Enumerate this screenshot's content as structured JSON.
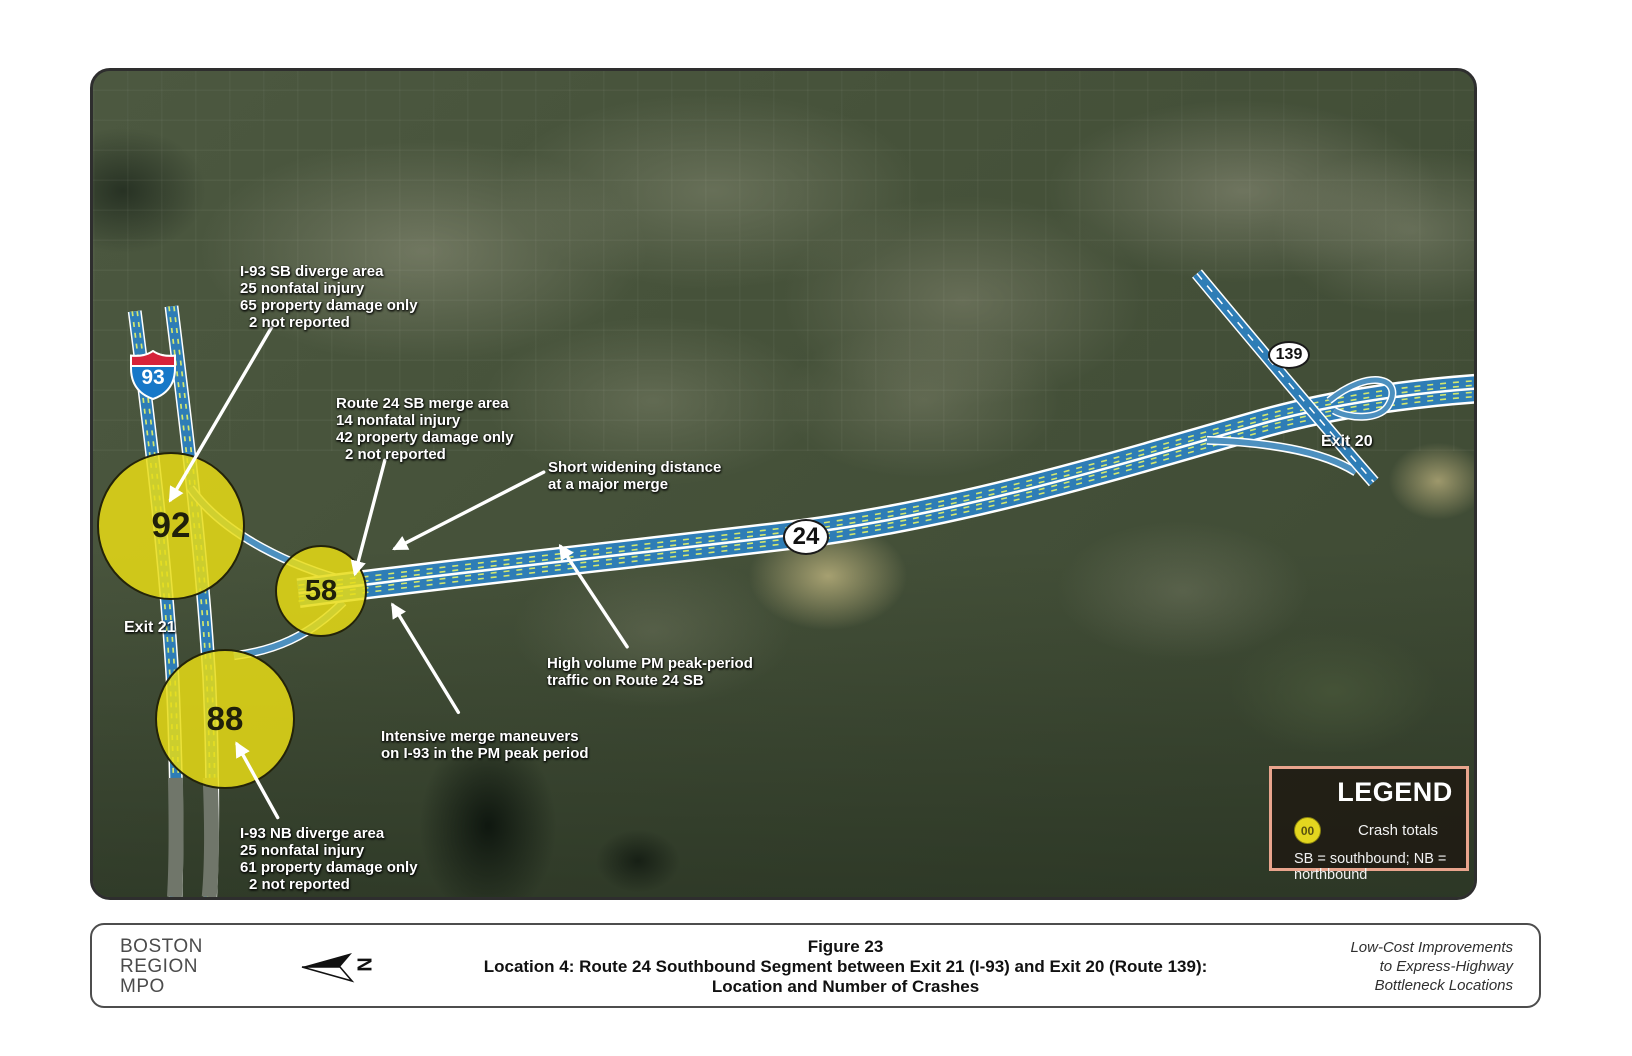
{
  "figure": {
    "map": {
      "shields": {
        "i93": "93",
        "route24": "24",
        "route139": "139"
      },
      "exit21": "Exit 21",
      "exit20": "Exit 20",
      "circles": {
        "sb_diverge": "92",
        "sb_merge": "58",
        "nb_diverge": "88"
      },
      "callouts": {
        "sb_diverge": {
          "l1": "I-93 SB diverge area",
          "l2": "25 nonfatal injury",
          "l3": "65 property damage only",
          "l4": "2 not reported"
        },
        "sb_merge": {
          "l1": "Route 24 SB merge area",
          "l2": "14 nonfatal injury",
          "l3": "42 property damage only",
          "l4": "2 not reported"
        },
        "short_widening": {
          "l1": "Short widening distance",
          "l2": "at a major merge"
        },
        "high_volume": {
          "l1": "High volume PM peak-period",
          "l2": "traffic on Route 24 SB"
        },
        "intensive_merge": {
          "l1": "Intensive merge maneuvers",
          "l2": "on I-93 in the PM peak period"
        },
        "nb_diverge": {
          "l1": "I-93 NB diverge area",
          "l2": "25 nonfatal injury",
          "l3": "61 property damage only",
          "l4": "2 not reported"
        }
      },
      "legend": {
        "title": "LEGEND",
        "symbol": "00",
        "item": "Crash totals",
        "note": "SB = southbound; NB = northbound"
      }
    },
    "footer": {
      "org1": "BOSTON",
      "org2": "REGION",
      "org3": "MPO",
      "north": "N",
      "cap1": "Figure 23",
      "cap2": "Location 4: Route 24 Southbound Segment between Exit 21 (I-93) and Exit 20 (Route 139):",
      "cap3": "Location and Number of Crashes",
      "note1": "Low-Cost Improvements",
      "note2": "to Express-Highway",
      "note3": "Bottleneck Locations"
    },
    "colors": {
      "crash_circle_fill": "#e7dc15",
      "highway_blue": "#2e7db6",
      "legend_border": "#e9a48d",
      "interstate_red": "#d6223a",
      "interstate_blue": "#1778c8"
    }
  }
}
